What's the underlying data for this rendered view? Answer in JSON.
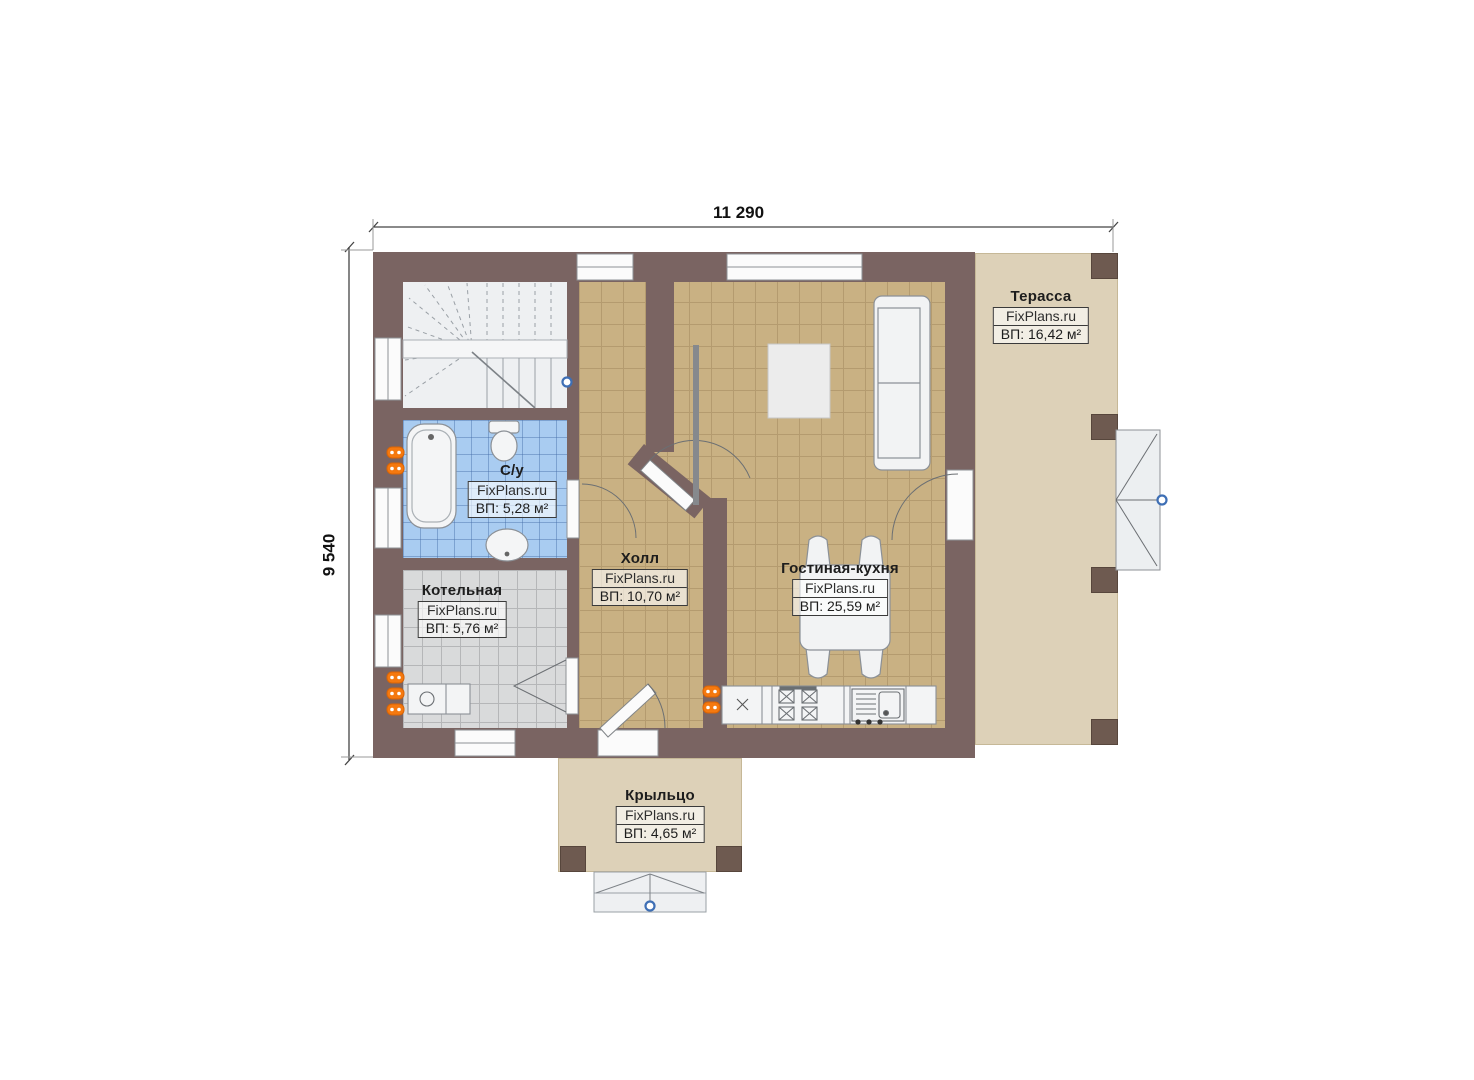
{
  "watermark": "FixPlans.ru",
  "dimensions": {
    "width": "11 290",
    "height": "9 540"
  },
  "rooms": {
    "terrace": {
      "name": "Терасса",
      "area": "ВП: 16,42 м²"
    },
    "bathroom": {
      "name": "С/у",
      "area": "ВП: 5,28 м²"
    },
    "boiler": {
      "name": "Котельная",
      "area": "ВП: 5,76 м²"
    },
    "hall": {
      "name": "Холл",
      "area": "ВП: 10,70 м²"
    },
    "living": {
      "name": "Гостиная-кухня",
      "area": "ВП: 25,59 м²"
    },
    "porch": {
      "name": "Крыльцо",
      "area": "ВП: 4,65 м²"
    }
  },
  "colors": {
    "wall": "#7a6462",
    "post": "#6e5a50",
    "floor_tile_tan": "#c9b183",
    "floor_tile_blue": "#a9ccf1",
    "floor_tile_gray": "#d9dadb",
    "terrace_slab": "#ddd1b8",
    "radiator_orange": "#f5790f",
    "marker_blue": "#3e6fb5"
  }
}
